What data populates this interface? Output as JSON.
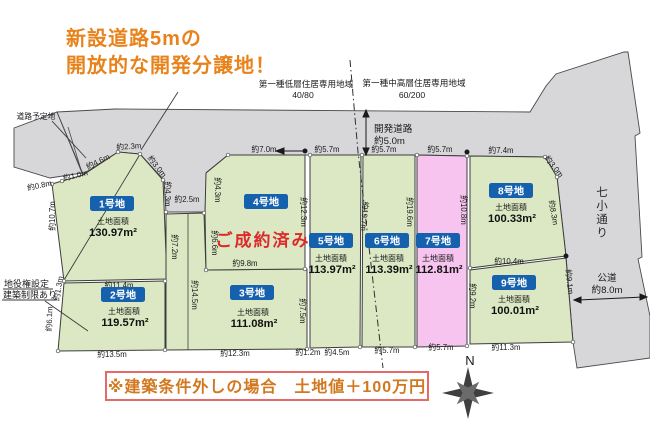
{
  "title": {
    "line1": "新設道路5mの",
    "line2": "開放的な開発分譲地！"
  },
  "zoning": {
    "left_name": "第一種低層住居専用地域",
    "left_ratio": "40/80",
    "right_name": "第一種中高層住居専用地域",
    "right_ratio": "60/200"
  },
  "roads": {
    "planned": "道路予定地",
    "development": "開発道路",
    "development_width": "約5.0m",
    "street_name": "七小通り",
    "public_road": "公道",
    "public_road_width": "約8.0m"
  },
  "easement": {
    "line1": "地役権設定",
    "line2": "建築制限あり"
  },
  "compass": {
    "north": "N"
  },
  "note": {
    "text": "※建築条件外しの場合　土地値＋100万円"
  },
  "colors": {
    "plot_green": "#dbe8c3",
    "plot_pink": "#f6c4ee",
    "road_gray": "#d7d7da",
    "badge_blue": "#1661ae",
    "title_orange": "#e8831c",
    "sold_red": "#dc2a2a"
  },
  "plots": [
    {
      "id": "1号地",
      "area_label": "土地面積",
      "area": "130.97m²",
      "status": "",
      "color": "#dbe8c3"
    },
    {
      "id": "2号地",
      "area_label": "土地面積",
      "area": "119.57m²",
      "status": "",
      "color": "#dbe8c3"
    },
    {
      "id": "3号地",
      "area_label": "土地面積",
      "area": "111.08m²",
      "status": "",
      "color": "#dbe8c3"
    },
    {
      "id": "4号地",
      "area_label": "",
      "area": "",
      "status": "ご成約済み",
      "color": "#dbe8c3"
    },
    {
      "id": "5号地",
      "area_label": "土地面積",
      "area": "113.97m²",
      "status": "",
      "color": "#dbe8c3"
    },
    {
      "id": "6号地",
      "area_label": "土地面積",
      "area": "113.39m²",
      "status": "",
      "color": "#dbe8c3"
    },
    {
      "id": "7号地",
      "area_label": "土地面積",
      "area": "112.81m²",
      "status": "",
      "color": "#f6c4ee"
    },
    {
      "id": "8号地",
      "area_label": "土地面積",
      "area": "100.33m²",
      "status": "",
      "color": "#dbe8c3"
    },
    {
      "id": "9号地",
      "area_label": "土地面積",
      "area": "100.01m²",
      "status": "",
      "color": "#dbe8c3"
    }
  ],
  "dims": [
    "約0.8m",
    "約1.0m",
    "約4.6m",
    "約2.3m",
    "約3.0m",
    "約4.3m",
    "約4.3m",
    "約2.5m",
    "約10.7m",
    "約1.3m",
    "約6.1m",
    "約11.4m",
    "約7.2m",
    "約14.5m",
    "約6.6m",
    "約9.8m",
    "約12.3m",
    "約7.5m",
    "約19.7m",
    "約19.6m",
    "約10.8m",
    "約9.2m",
    "約10.4m",
    "約8.3m",
    "約9.1m",
    "約3.0m",
    "約7.0m",
    "約5.7m",
    "約5.7m",
    "約5.7m",
    "約7.4m",
    "約13.5m",
    "約12.3m",
    "約1.2m",
    "約4.5m",
    "約5.7m",
    "約5.7m",
    "約11.3m"
  ]
}
